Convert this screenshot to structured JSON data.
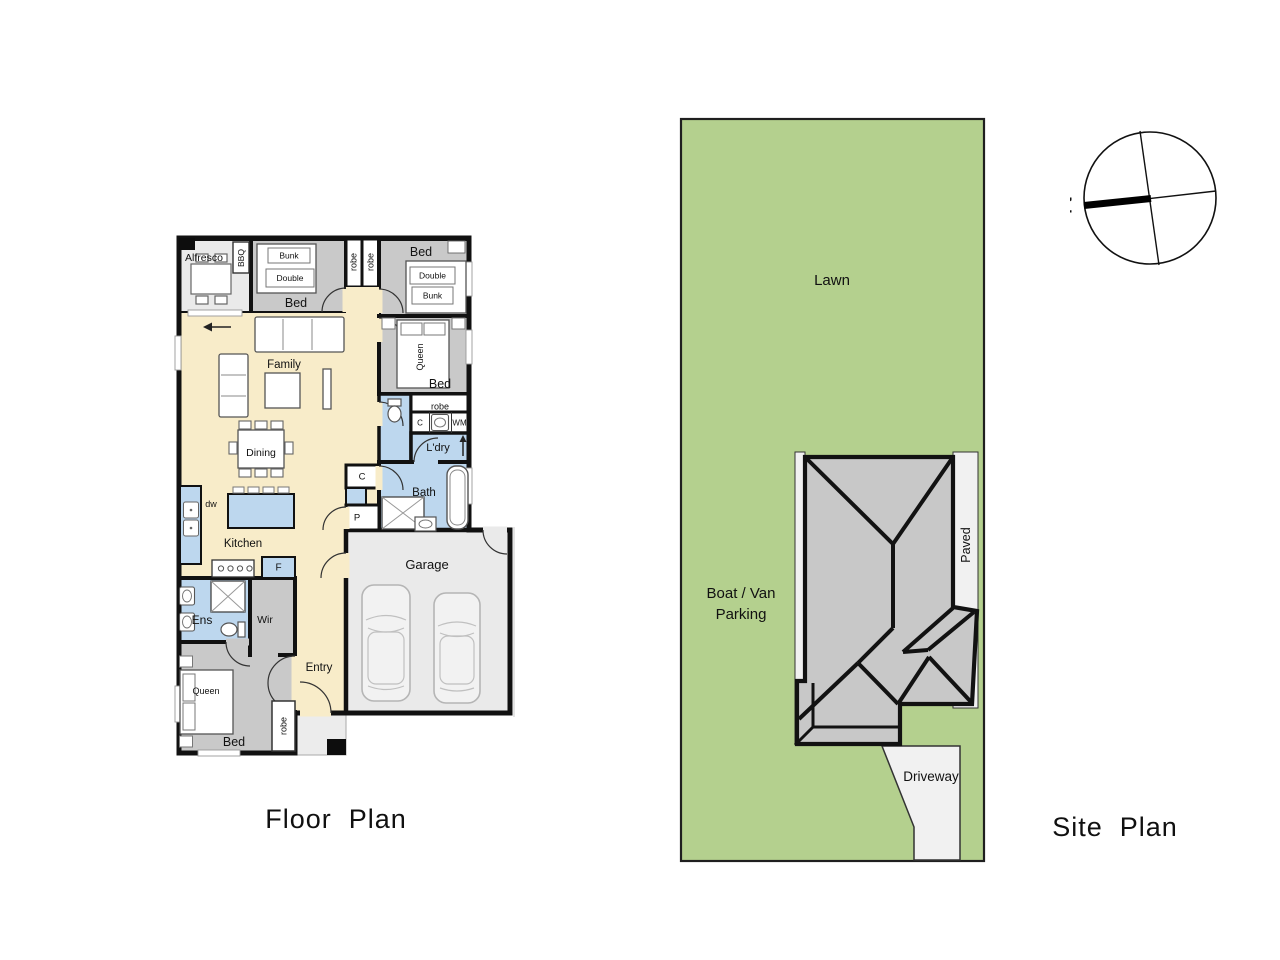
{
  "titles": {
    "floor_plan": "Floor  Plan",
    "site_plan": "Site  Plan"
  },
  "compass": {
    "north": "N"
  },
  "fp": {
    "alfresco": "Alfresco",
    "bbq": "BBQ",
    "bed2_label": "Bed",
    "bed2_bunk": "Bunk",
    "bed2_double": "Double",
    "robe_a": "robe",
    "robe_b": "robe",
    "bed1_label": "Bed",
    "bed1_double": "Double",
    "bed1_bunk": "Bunk",
    "family": "Family",
    "bed3_label": "Bed",
    "bed3_queen": "Queen",
    "bed3_robe": "robe",
    "laundry_c": "C",
    "laundry_wm": "WM",
    "ldry": "L'dry",
    "dining": "Dining",
    "hall_c": "C",
    "pantry": "P",
    "bath": "Bath",
    "dw": "dw",
    "kitchen": "Kitchen",
    "fridge": "F",
    "garage": "Garage",
    "ens": "Ens",
    "wir": "Wir",
    "entry": "Entry",
    "master_label": "Bed",
    "master_queen": "Queen",
    "master_robe": "robe"
  },
  "sp": {
    "lawn": "Lawn",
    "boat_van_line1": "Boat / Van",
    "boat_van_line2": "Parking",
    "paved": "Paved",
    "driveway": "Driveway"
  },
  "colors": {
    "living_cream": "#f8ecc9",
    "wet_blue": "#bdd7ee",
    "bedroom_grey": "#c9c9c9",
    "outdoor_grey": "#eaeaea",
    "lawn_green": "#b4d08e",
    "house_grey": "#c8c8c8",
    "paved_grey": "#f1f1f1",
    "wall_black": "#111111"
  }
}
